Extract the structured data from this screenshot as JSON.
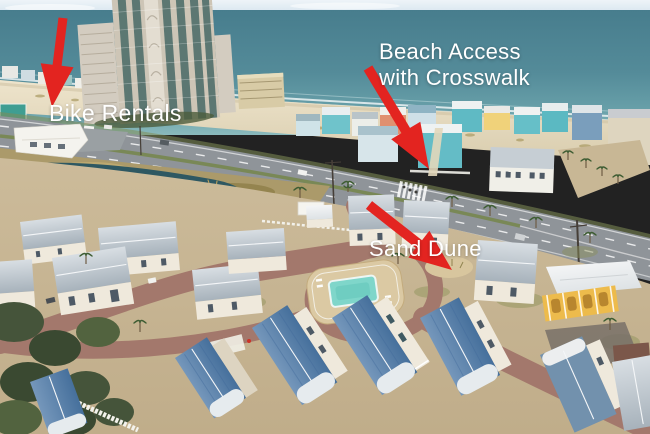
{
  "annotations": {
    "bike_rentals": {
      "label": "Bike Rentals"
    },
    "beach_access": {
      "line1": "Beach Access",
      "line2": "with Crosswalk"
    },
    "sand_dune": {
      "label": "Sand Dune"
    }
  },
  "style": {
    "arrow_color": "#e32420",
    "label_color": "#ffffff",
    "palette": {
      "sky": "#dceaf2",
      "ocean": "#4d8292",
      "beach_sand": "#e6dcc2",
      "highway": "#8f9499",
      "community_road": "#a3786c",
      "pool_water": "#7fd6ca",
      "pool_deck": "#dbc9a3",
      "roof_blue": "#5c84ad",
      "roof_gray": "#c3ccd3",
      "cottage_wall": "#efe9dc",
      "clubhouse_yellow": "#edbb4c",
      "lagoon_water": "#2e5862",
      "marsh_grass": "#ab9a6a",
      "trees": "#45543a"
    }
  }
}
